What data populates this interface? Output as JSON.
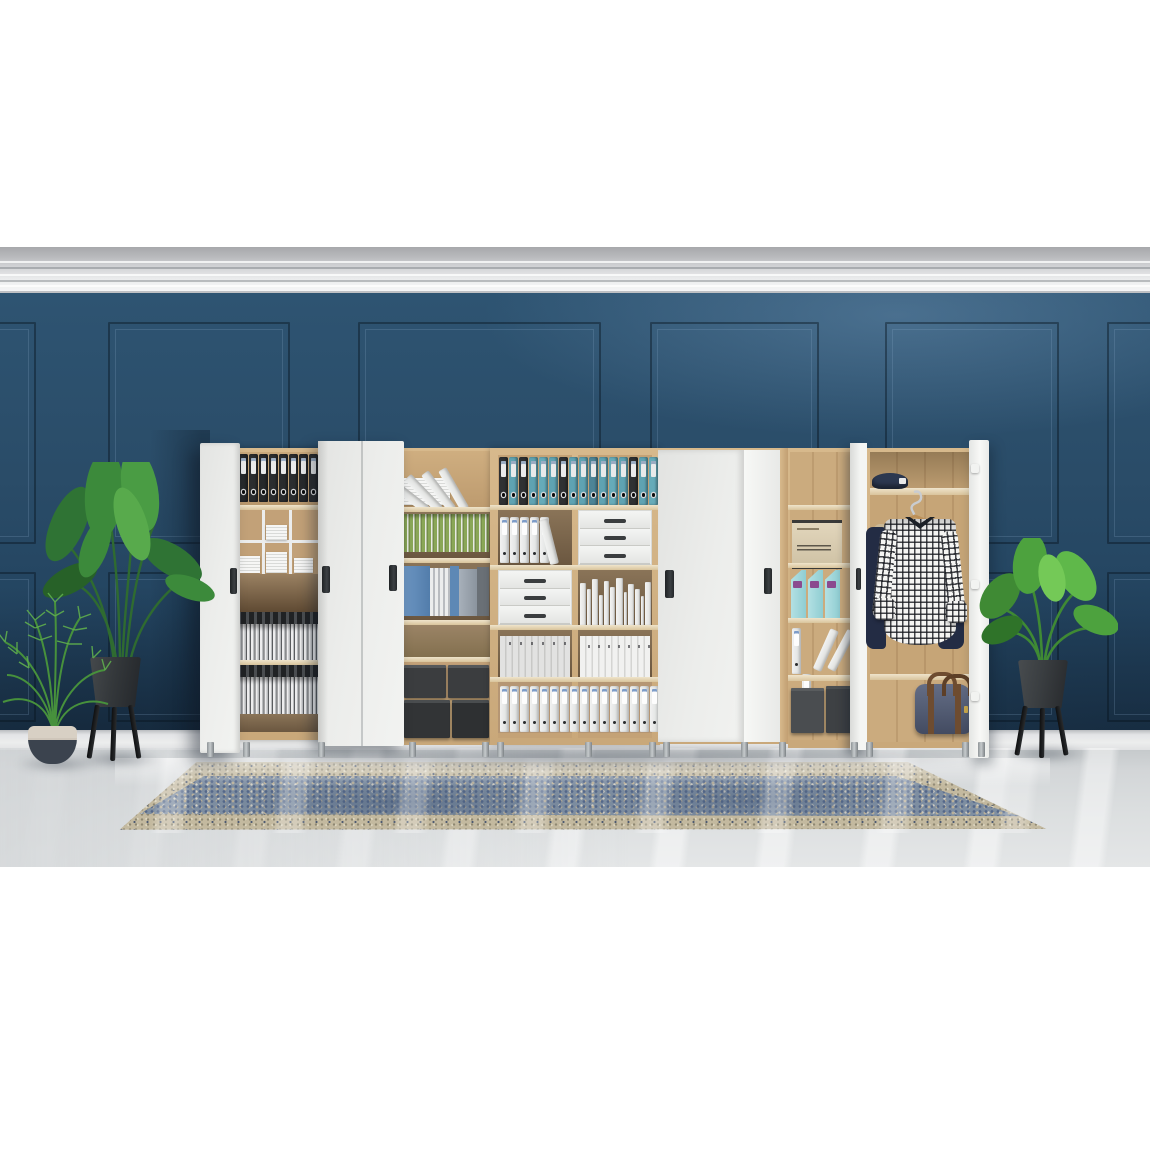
{
  "scene": {
    "title": "Office storage wall units with open doors against a dark blue classic paneled wall",
    "setting": "white letterboxed product photo, grey marble floor, vintage blue rug, green potted plants",
    "palette": {
      "wall_blue": "#27496a",
      "wall_light": "#3c607e",
      "wall_dark": "#1c364e",
      "molding_white": "#f1f2f3",
      "floor_grey": "#d8dbdc",
      "floor_streak": "#f2f4f4",
      "oak": "#d2b286",
      "walnut": "#6b5740",
      "door_white": "#ecedeb",
      "binder_black": "#2b2d2f",
      "binder_teal": "#5fa3b2",
      "binder_white": "#eef0ef",
      "box_charcoal": "#3b3d3f",
      "archive_beige": "#d9cdb2",
      "magazine_aqua": "#9fd4d8",
      "shirt_check": "#16181e",
      "garment_navy": "#232c44",
      "bag_navy": "#525b72",
      "leaf_green": "#3f8a3c",
      "pot_charcoal": "#35393c",
      "pot_cream": "#d5cdc1",
      "rug_border": "#c3b99f",
      "rug_field": "#7e8ea1"
    },
    "wall": {
      "panels_upper": [
        {
          "x": -60,
          "w": 92
        },
        {
          "x": 108,
          "w": 178
        },
        {
          "x": 358,
          "w": 239
        },
        {
          "x": 650,
          "w": 165
        },
        {
          "x": 885,
          "w": 170
        },
        {
          "x": 1107,
          "w": 160
        }
      ],
      "panels_lower": [
        {
          "x": -60,
          "w": 92
        },
        {
          "x": 108,
          "w": 178
        },
        {
          "x": 358,
          "w": 239
        },
        {
          "x": 650,
          "w": 165
        },
        {
          "x": 885,
          "w": 170
        },
        {
          "x": 1107,
          "w": 160
        }
      ]
    },
    "cabinet": {
      "module1_black_binders": [
        "#27292b",
        "#2b2d2f",
        "#26282a",
        "#2b2d2f",
        "#292b2d",
        "#2b2d2f",
        "#27292b",
        "#2b2d2f"
      ],
      "module3_colA_row1": [
        "#2f3133",
        "#5fa3b2",
        "#2f3133",
        "#5fa3b2",
        "#66abb9",
        "#5fa3b2",
        "#2f3133",
        "#5fa3b2"
      ],
      "module3_colB_row1": [
        "#5fa3b2",
        "#4d8496",
        "#5fa3b2",
        "#66abb9",
        "#5fa3b2",
        "#2f3133",
        "#5fa3b2",
        "#66abb9"
      ],
      "module3_colA_row2_whites": [
        1,
        2,
        3,
        4,
        5
      ],
      "module3_colB_row3_books": [
        {
          "w": 6,
          "h": 42
        },
        {
          "w": 5,
          "h": 36
        },
        {
          "w": 6,
          "h": 46
        },
        {
          "w": 4,
          "h": 30
        },
        {
          "w": 6,
          "h": 44
        },
        {
          "w": 5,
          "h": 38
        },
        {
          "w": 7,
          "h": 47
        },
        {
          "w": 4,
          "h": 33
        },
        {
          "w": 6,
          "h": 41
        },
        {
          "w": 5,
          "h": 36
        },
        {
          "w": 4,
          "h": 29
        },
        {
          "w": 6,
          "h": 43
        }
      ],
      "module3_colA_row5_whites": [
        1,
        2,
        3,
        4,
        5,
        6,
        7,
        8
      ],
      "module3_colB_row5_whites": [
        1,
        2,
        3,
        4,
        5,
        6,
        7,
        8
      ],
      "module2_leaning_slabs": [
        {
          "x": 18,
          "r": "-52deg"
        },
        {
          "x": 31,
          "r": "-44deg"
        },
        {
          "x": 44,
          "r": "-37deg"
        },
        {
          "x": 57,
          "r": "-30deg"
        }
      ],
      "module5_aqua_boxes": [
        1,
        2,
        3
      ],
      "legs": [
        {
          "x": 207
        },
        {
          "x": 243
        },
        {
          "x": 318
        },
        {
          "x": 409
        },
        {
          "x": 482
        },
        {
          "x": 497
        },
        {
          "x": 585
        },
        {
          "x": 649
        },
        {
          "x": 663
        },
        {
          "x": 741
        },
        {
          "x": 779
        },
        {
          "x": 851
        },
        {
          "x": 866
        },
        {
          "x": 962
        },
        {
          "x": 978
        }
      ]
    }
  }
}
